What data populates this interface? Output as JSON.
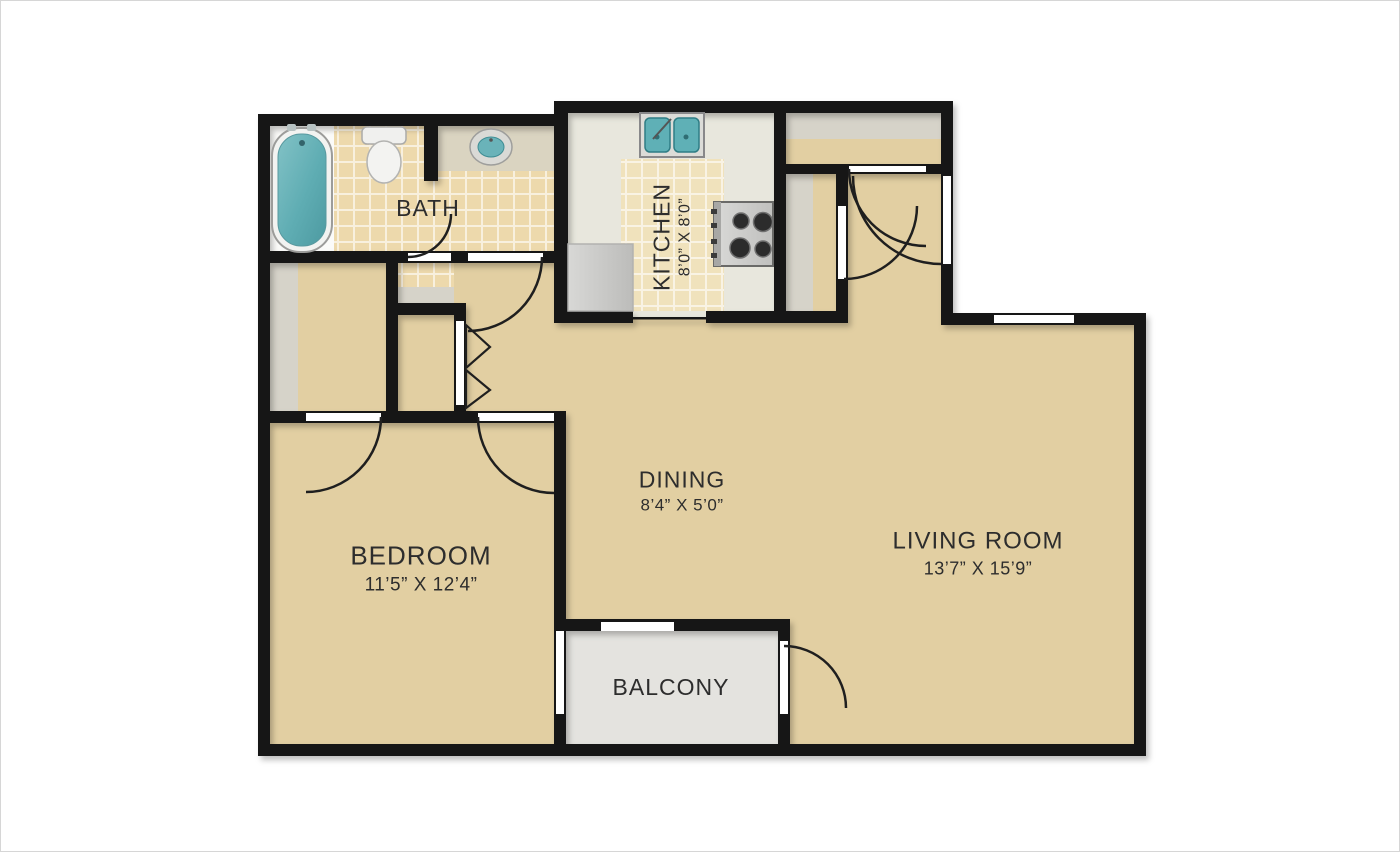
{
  "floor_plan": {
    "rooms": {
      "bath": {
        "label": "BATH"
      },
      "kitchen": {
        "label": "KITCHEN",
        "dimensions": "8’0” X 8’0”"
      },
      "dining": {
        "label": "DINING",
        "dimensions": "8’4” X 5’0”"
      },
      "living_room": {
        "label": "LIVING ROOM",
        "dimensions": "13’7” X 15’9”"
      },
      "bedroom": {
        "label": "BEDROOM",
        "dimensions": "11’5” X 12’4”"
      },
      "balcony": {
        "label": "BALCONY"
      }
    },
    "fixtures": [
      "bathtub",
      "toilet",
      "bathroom-sink",
      "kitchen-double-sink",
      "stove",
      "kitchen-counter"
    ],
    "colors": {
      "wall": "#141414",
      "floor_tan": "#e2cfa2",
      "tile": "#edd9ac",
      "kitchen_tile": "#f0e2bc",
      "kitchen_floor": "#e8e7dd",
      "closet_gray": "#d6d3c9",
      "balcony_gray": "#e4e3df",
      "counter_beige": "#dad4c1",
      "fixture_teal": "#5fb0b6",
      "text": "#2d2d2d"
    }
  }
}
